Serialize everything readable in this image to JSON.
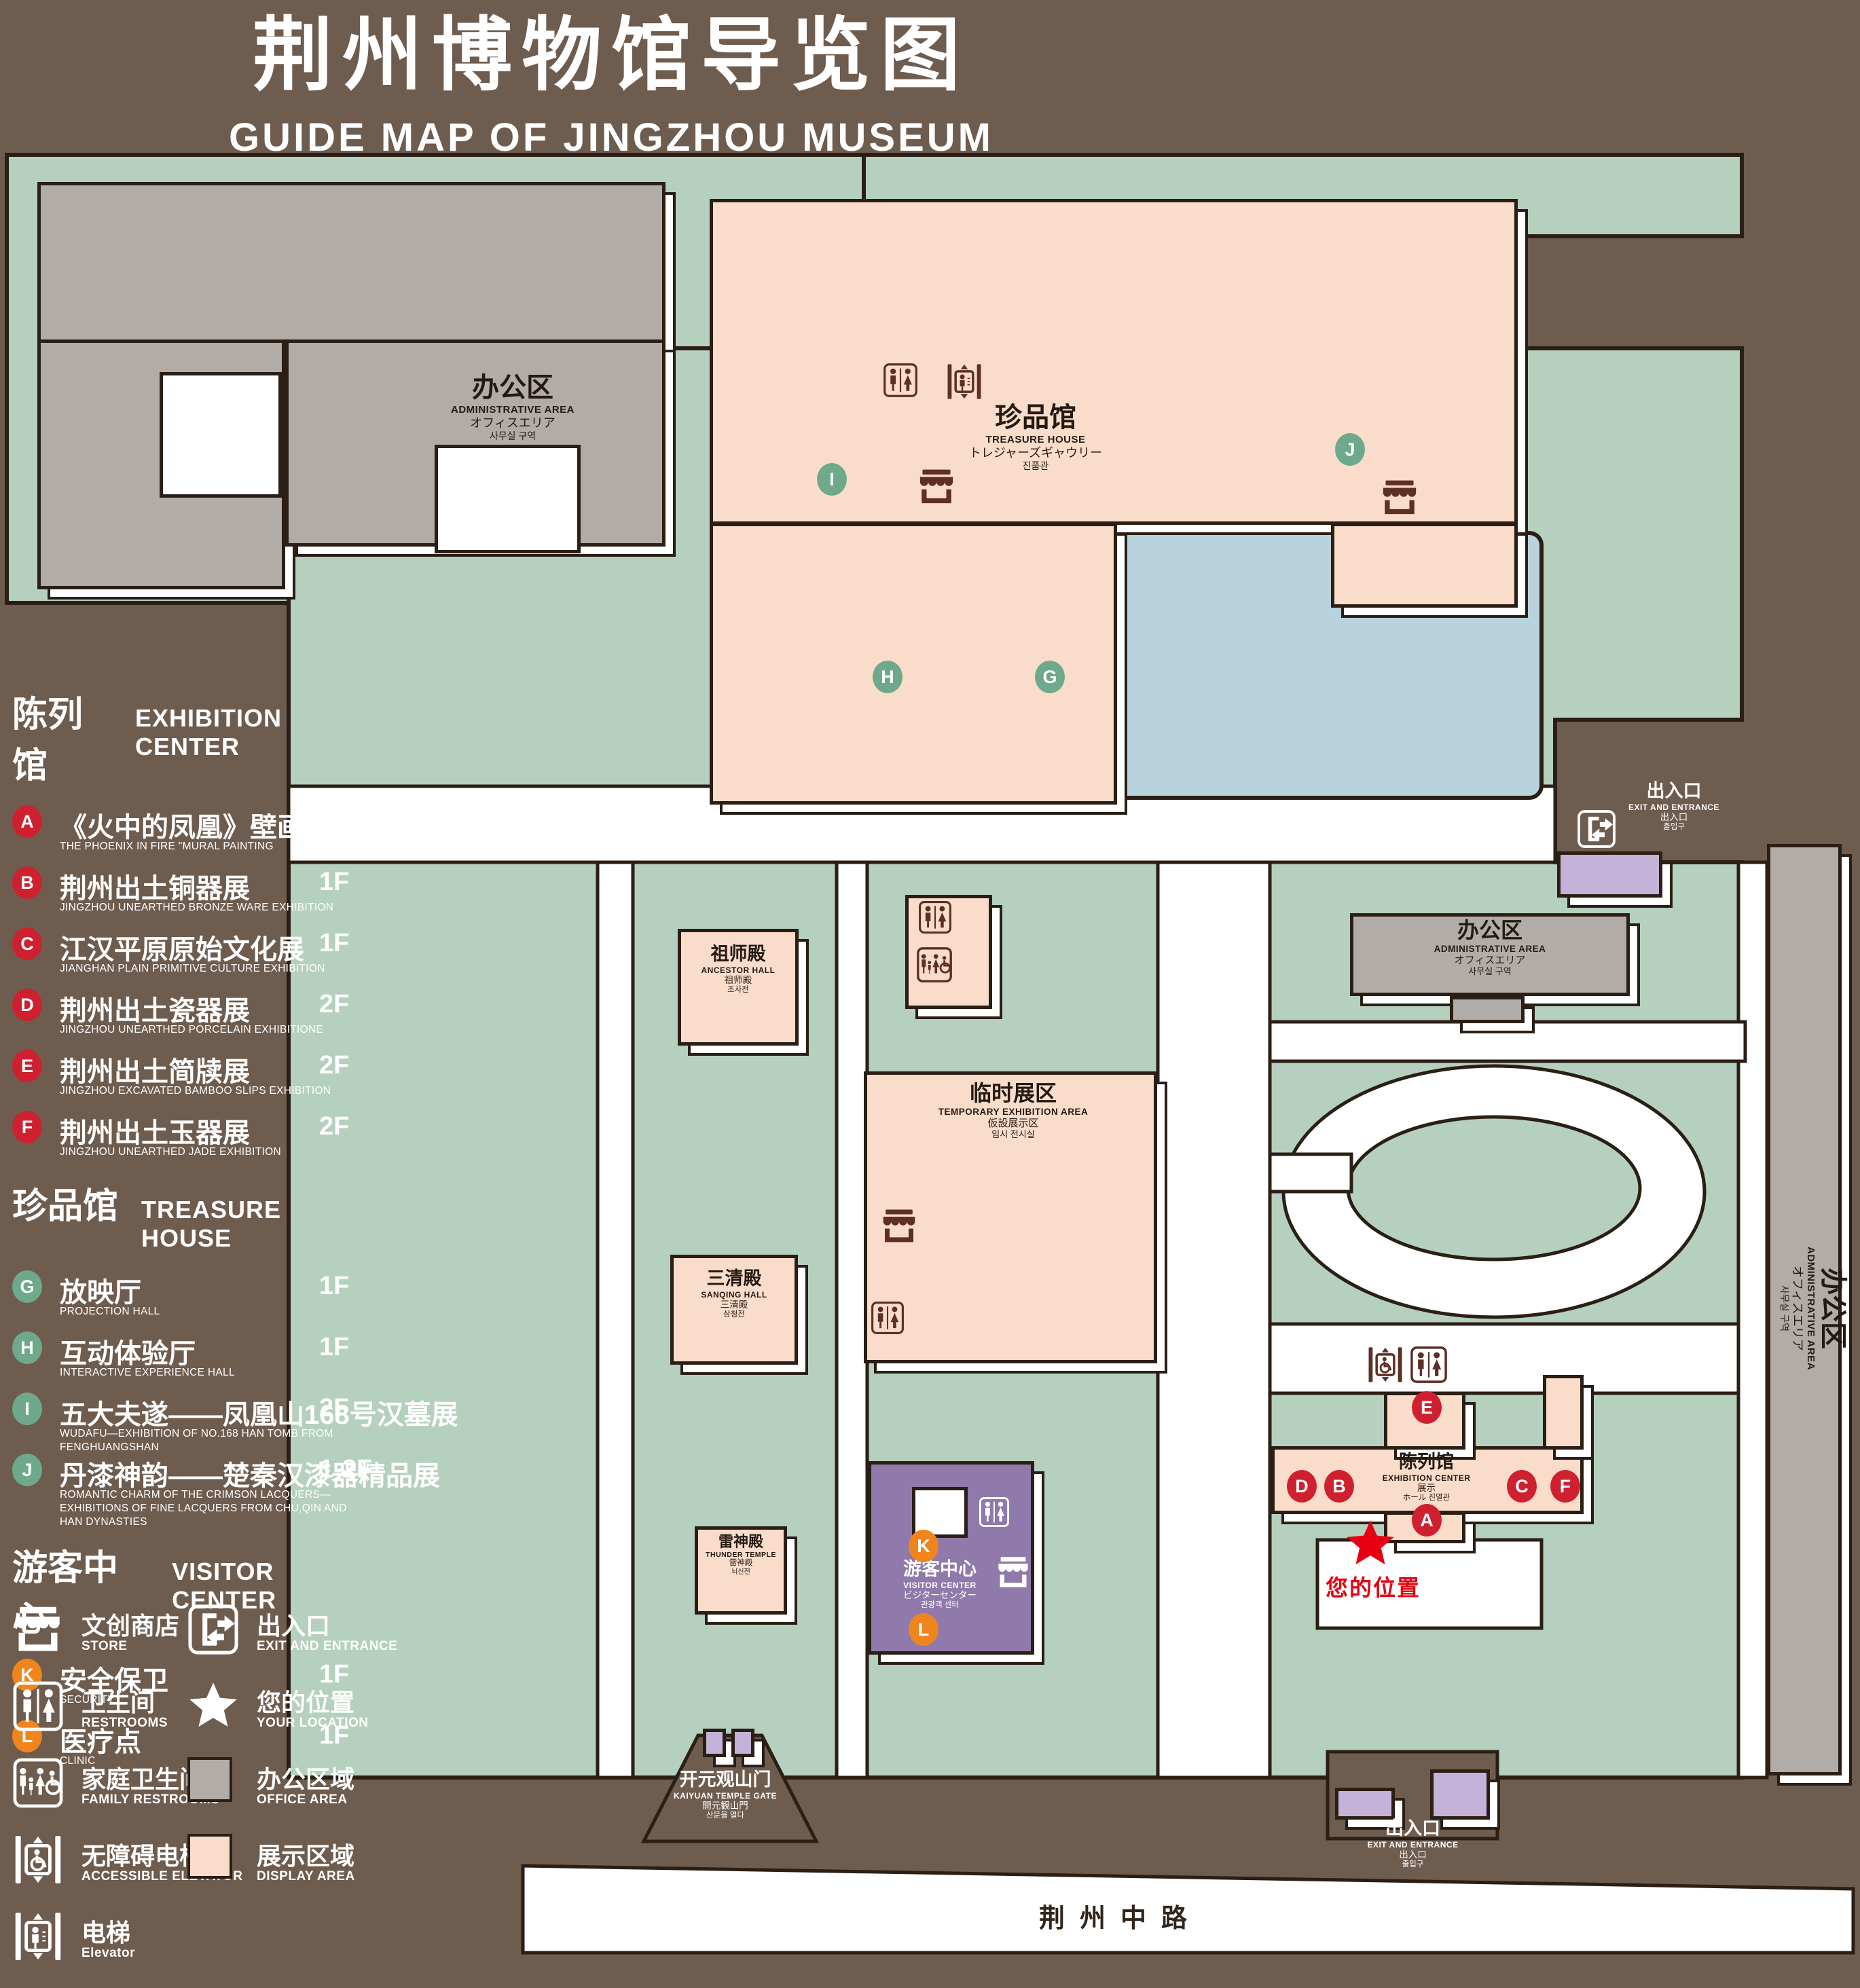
{
  "header": {
    "title": "荆州博物馆导览图",
    "subtitle": "GUIDE MAP OF JINGZHOU MUSEUM"
  },
  "legend": {
    "sections": [
      {
        "zh": "陈列馆",
        "en": "EXHIBITION CENTER",
        "badge_color": "#cf202f",
        "items": [
          {
            "letter": "A",
            "zh": "《火中的凤凰》壁画",
            "en": "THE PHOENIX IN FIRE \"MURAL PAINTING",
            "floor": "1F"
          },
          {
            "letter": "B",
            "zh": "荆州出土铜器展",
            "en": "JINGZHOU UNEARTHED BRONZE WARE EXHIBITION",
            "floor": "1F"
          },
          {
            "letter": "C",
            "zh": "江汉平原原始文化展",
            "en": "JIANGHAN PLAIN PRIMITIVE CULTURE EXHIBITION",
            "floor": "1F"
          },
          {
            "letter": "D",
            "zh": "荆州出土瓷器展",
            "en": "JINGZHOU UNEARTHED PORCELAIN EXHIBITIONE",
            "floor": "2F"
          },
          {
            "letter": "E",
            "zh": "荆州出土简牍展",
            "en": "JINGZHOU EXCAVATED BAMBOO SLIPS EXHIBITION",
            "floor": "2F"
          },
          {
            "letter": "F",
            "zh": "荆州出土玉器展",
            "en": "JINGZHOU UNEARTHED JADE EXHIBITION",
            "floor": "2F"
          }
        ]
      },
      {
        "zh": "珍品馆",
        "en": "TREASURE HOUSE",
        "badge_color": "#6fa98c",
        "items": [
          {
            "letter": "G",
            "zh": "放映厅",
            "en": "PROJECTION HALL",
            "floor": "1F"
          },
          {
            "letter": "H",
            "zh": "互动体验厅",
            "en": "INTERACTIVE EXPERIENCE HALL",
            "floor": "1F"
          },
          {
            "letter": "I",
            "zh": "五大夫遂——凤凰山168号汉墓展",
            "en": "WUDAFU—EXHIBITION OF NO.168 HAN TOMB FROM FENGHUANGSHAN",
            "floor": "2F"
          },
          {
            "letter": "J",
            "zh": "丹漆神韵——楚秦汉漆器精品展",
            "en": "ROMANTIC CHARM OF THE CRIMSON LACQUERS—EXHIBITIONS OF FINE LACQUERS FROM CHU,QIN AND HAN DYNASTIES",
            "floor": "1-2F"
          }
        ]
      },
      {
        "zh": "游客中心",
        "en": "VISITOR CENTER",
        "badge_color": "#f0851d",
        "items": [
          {
            "letter": "K",
            "zh": "安全保卫",
            "en": "SECURITY",
            "floor": "1F"
          },
          {
            "letter": "L",
            "zh": "医疗点",
            "en": "CLINIC",
            "floor": "1F"
          }
        ]
      }
    ],
    "symbols_left": [
      {
        "icon": "store",
        "zh": "文创商店",
        "en": "STORE"
      },
      {
        "icon": "restroom",
        "zh": "卫生间",
        "en": "RESTROOMS"
      },
      {
        "icon": "family-restroom",
        "zh": "家庭卫生间",
        "en": "FAMILY RESTROOMS"
      },
      {
        "icon": "accessible-elevator",
        "zh": "无障碍电梯",
        "en": "ACCESSIBLE ELEVATOR"
      },
      {
        "icon": "elevator",
        "zh": "电梯",
        "en": "Elevator"
      }
    ],
    "symbols_right": [
      {
        "icon": "exit",
        "zh": "出入口",
        "en": "EXIT AND ENTRANCE"
      },
      {
        "icon": "star",
        "zh": "您的位置",
        "en": "YOUR LOCATION"
      },
      {
        "icon": "office-swatch",
        "zh": "办公区域",
        "en": "OFFICE AREA"
      },
      {
        "icon": "display-swatch",
        "zh": "展示区域",
        "en": "DISPLAY AREA"
      }
    ]
  },
  "map": {
    "buildings": {
      "admin_top": {
        "l1": "办公区",
        "l2": "ADMINISTRATIVE AREA",
        "l3": "オフィスエリア",
        "l4": "사무실 구역"
      },
      "treasure_house": {
        "l1": "珍品馆",
        "l2": "TREASURE HOUSE",
        "l3": "トレジャーズギャウリー",
        "l4": "진품관"
      },
      "ancestor_hall": {
        "l1": "祖师殿",
        "l2": "ANCESTOR HALL",
        "l3": "祖师殿",
        "l4": "조사전"
      },
      "temporary_area": {
        "l1": "临时展区",
        "l2": "TEMPORARY EXHIBITION AREA",
        "l3": "仮設展示区",
        "l4": "임시 전시실"
      },
      "admin_right": {
        "l1": "办公区",
        "l2": "ADMINISTRATIVE AREA",
        "l3": "オフィスエリア",
        "l4": "사무실 구역"
      },
      "admin_side": {
        "l1": "办公区",
        "l2": "ADMINISTRATIVE AREA",
        "l3": "オフィスエリア",
        "l4": "사무실 구역"
      },
      "sanqing_hall": {
        "l1": "三清殿",
        "l2": "SANQING HALL",
        "l3": "三清殿",
        "l4": "삼청전"
      },
      "thunder_temple": {
        "l1": "雷神殿",
        "l2": "THUNDER TEMPLE",
        "l3": "雷神殿",
        "l4": "뇌신전"
      },
      "visitor_center": {
        "l1": "游客中心",
        "l2": "VISITOR CENTER",
        "l3": "ビジターセンター",
        "l4": "관광객 센터"
      },
      "exhibition_center": {
        "l1": "陈列馆",
        "l2": "EXHIBITION CENTER",
        "l3": "展示",
        "l4": "ホール 진열관"
      },
      "gate": {
        "l1": "开元观山门",
        "l2": "KAIYUAN TEMPLE GATE",
        "l3": "開元観山門",
        "l4": "산문을 열다"
      },
      "exit_top": {
        "l1": "出入口",
        "l2": "EXIT AND ENTRANCE",
        "l3": "出入口",
        "l4": "출입구"
      },
      "exit_bottom": {
        "l1": "出入口",
        "l2": "EXIT AND ENTRANCE",
        "l3": "出入口",
        "l4": "출입구"
      }
    },
    "your_location": "您的位置",
    "road": "荆州中路"
  },
  "colors": {
    "background": "#6e5c4f",
    "lawn": "#b5d0be",
    "display_area": "#fadccb",
    "office_area": "#b2aca8",
    "pond": "#b8d3de",
    "visitor_center": "#8f7aab",
    "gate_purple": "#c4b2d8",
    "badge_red": "#cf202f",
    "badge_green": "#6fa98c",
    "badge_orange": "#f0851d",
    "icon_brown": "#5d2f26",
    "location_red": "#e60012"
  }
}
